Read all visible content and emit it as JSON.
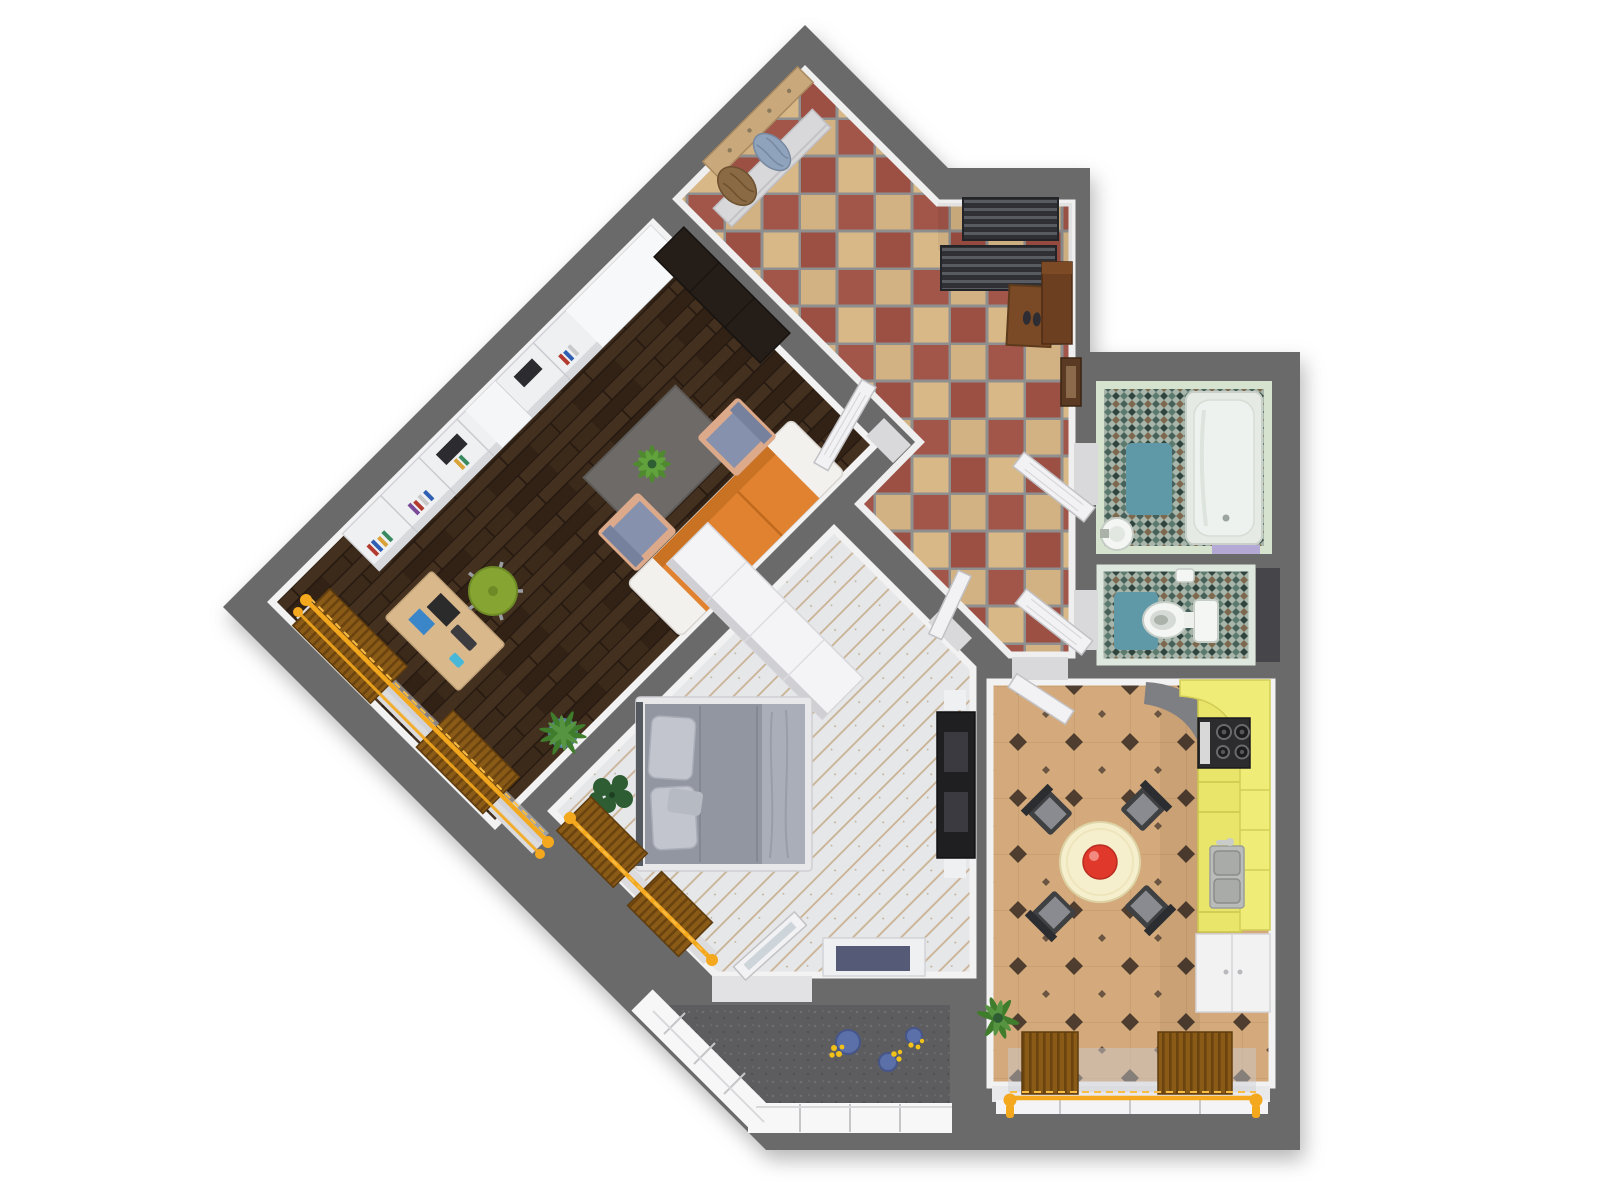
{
  "scene": {
    "name": "3D apartment floor plan, top-down render",
    "style": "photoreal dollhouse view, no visible text",
    "background": "#ffffff"
  },
  "palette": {
    "wall": "#6a6a6a",
    "innerFace": "#f2f2f2",
    "threshold": "#d9d9db",
    "doorWhite": "#f2f2f4",
    "lrFloorBase": "#3a2a1e",
    "lrPlankA": "#43301f",
    "lrPlankB": "#312215",
    "lrPlankLine": "#241810",
    "bedFloorBase": "#e6e7e9",
    "bedPlankLine": "#c9b192",
    "hallGrout": "#8f8f8f",
    "hallTileTan": "#d9b887",
    "hallTileRed": "#9c4f43",
    "mosaicBase": "#a8b5aa",
    "mosaicGreen": "#46615a",
    "mosaicDeep": "#2f453e",
    "mosaicBrown": "#7d6a4e",
    "mosaicTeal": "#5d7a6e",
    "bathWallTint": "#d6e3cf",
    "kitchenTileBase": "#d4aa7c",
    "kitchenTileLine": "#c49a6c",
    "kitchenDiamond": "#4f3e30",
    "balconyFloor": "#5d5d5f",
    "glazing": "#f7f7f8",
    "mullion": "#c6c6c9",
    "cabinetYellow": "#e9e46a",
    "cabinetYellowTall": "#f0ec78",
    "counterGray": "#7e7f82",
    "stoveBlack": "#2c2c2e",
    "steel": "#b9bcb9",
    "applianceWhite": "#f2f2f3",
    "tableCream": "#f6efcd",
    "bowlRed": "#e0392c",
    "diningChair": "#3f4042",
    "sofaOrange": "#e0822f",
    "sofaArm": "#f3f1ee",
    "armchairBlue": "#8691ad",
    "armchairWood": "#dca98b",
    "rugGray": "#6e6a67",
    "plantGreen": "#4f8a2f",
    "plantDark": "#2e5d33",
    "potBlue": "#6aa0c8",
    "potNavy": "#5b6fa8",
    "flowerYellow": "#f2c218",
    "chairGreen": "#85a432",
    "deskTan": "#d9b98c",
    "laptopDark": "#2b2b2b",
    "screenBlue": "#3a86c8",
    "bedSpread": "#9196a0",
    "bedThrow": "#aaaeb8",
    "pillowGray": "#c2c5cd",
    "bedFrame": "#e8e8ea",
    "headboard": "#555a60",
    "tvBlack": "#1f1f22",
    "wardrobeWhite": "#f4f4f6",
    "shelfWhite": "#eef0f2",
    "darkCabinet": "#241d18",
    "tubShell": "#e6eae4",
    "tubInner": "#eef2ee",
    "matTeal": "#5f99a8",
    "lavender": "#b4a9d4",
    "porcelain": "#f4f6f4",
    "rodYellow": "#f4a81d",
    "rodLight": "#f7bd45",
    "blindBrown": "#8a5a17",
    "blindStripe": "#6a430f",
    "sheerGray": "#c9cbd2",
    "sillGray": "#dcdcde",
    "coatRackTan": "#c9a87c",
    "benchGray": "#d8d8da",
    "towelBlue": "#8fa3bd",
    "coatBrown": "#8a6a45",
    "shoeRack": "#2f3034",
    "shoeRackSlat": "#595b63",
    "matBrown": "#7a4a26",
    "hallCabinet": "#6b3f1f",
    "frameBrown": "#5a3a22",
    "navyDesk": "#555a77",
    "shaftDark": "#46464a"
  },
  "rooms": [
    {
      "id": "living-room",
      "name": "Living room",
      "floor": "dark walnut planks laid diagonally"
    },
    {
      "id": "bedroom",
      "name": "Bedroom",
      "floor": "whitewashed planks laid diagonally"
    },
    {
      "id": "entry-hall",
      "name": "Entry hall",
      "floor": "red and tan checkerboard tile"
    },
    {
      "id": "bathroom",
      "name": "Bathroom",
      "floor": "green mosaic tile"
    },
    {
      "id": "wc",
      "name": "WC",
      "floor": "green mosaic tile"
    },
    {
      "id": "kitchen",
      "name": "Kitchen",
      "floor": "beige tile with dark diamond accents"
    },
    {
      "id": "balcony",
      "name": "Glazed balcony",
      "floor": "dark speckled screed"
    }
  ],
  "furniture": {
    "living_room": [
      "white wall shelving with books",
      "dark wardrobe",
      "orange sofa with white armrests",
      "blue armchair x2",
      "gray rug with potted palm",
      "floor plant in blue pot",
      "wooden desk with computer, keyboard and phone",
      "green swivel chair",
      "two wood window blinds with yellow curtain rods",
      "open white door"
    ],
    "bedroom": [
      "double bed with gray duvet and two pillows",
      "white wardrobe",
      "black TV / media unit",
      "white desk with dark top",
      "dark green plant",
      "open window sash",
      "two wood window blinds with yellow curtain rod"
    ],
    "entry_hall": [
      "coat rack with blue towel and brown coat",
      "wall bench",
      "two-tier metal shoe rack",
      "brown doormat with shoes",
      "brown cabinet",
      "picture frame",
      "open doors to bathroom and WC"
    ],
    "bathroom": [
      "bathtub",
      "pedestal sink",
      "teal bath mat",
      "lavender towel"
    ],
    "wc": [
      "toilet with tank",
      "teal mat",
      "small cistern box"
    ],
    "kitchen": [
      "round cream table with red bowl",
      "four dark chairs",
      "yellow kitchen counters",
      "cooktop with four burners",
      "double stainless sink with faucet",
      "white appliance cabinet",
      "plant",
      "two wood window blinds with yellow curtain rod",
      "open white door"
    ],
    "balcony": [
      "blue flower pots with yellow flowers",
      "white window glazing"
    ]
  }
}
